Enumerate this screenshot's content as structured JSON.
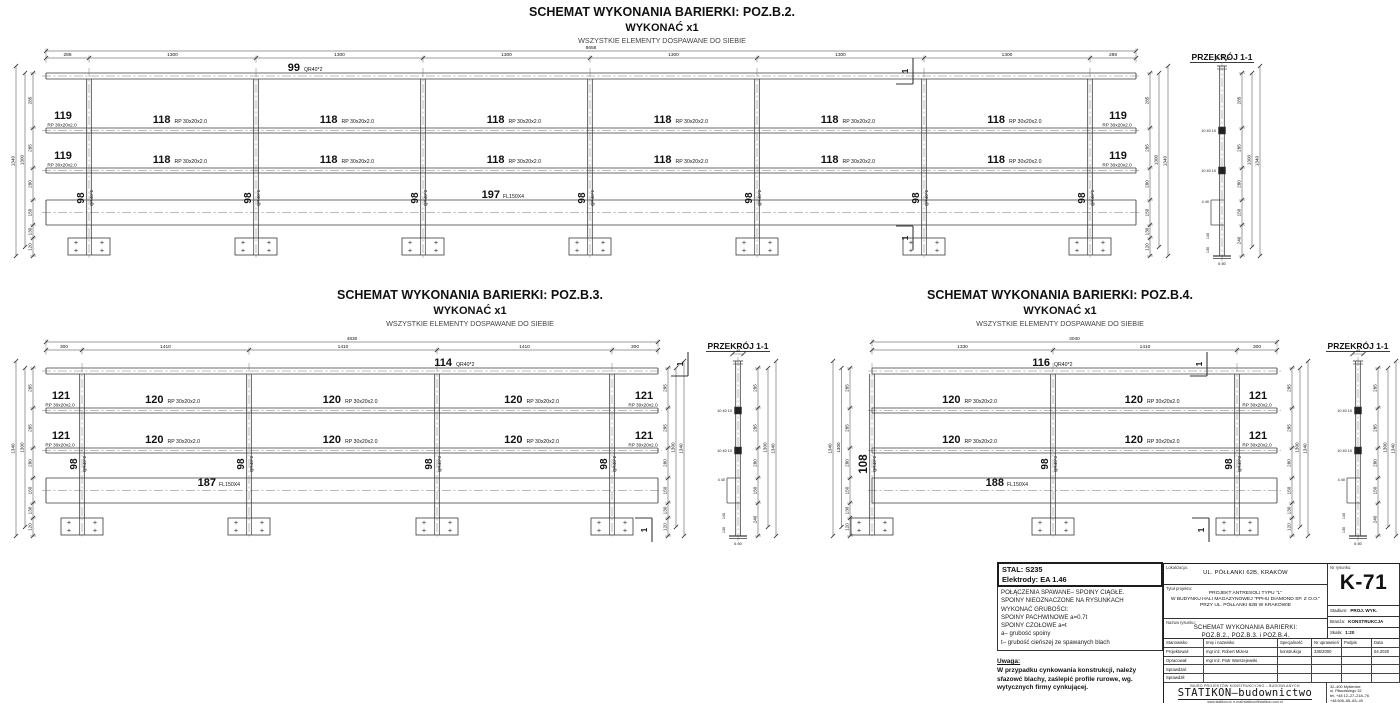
{
  "sheet": {
    "background": "#ffffff",
    "line_color": "#3a3a3a",
    "text_color": "#111111"
  },
  "drawings": {
    "b2": {
      "title": "SCHEMAT WYKONANIA BARIERKI: POZ.B.2.",
      "make_label": "WYKONAĆ x1",
      "weld_note": "WSZYSTKIE ELEMENTY DOSPAWANE DO SIEBIE",
      "total_dim": "8658",
      "top_dims": [
        "288",
        "1300",
        "1300",
        "1300",
        "1300",
        "1300",
        "1300",
        "288"
      ],
      "side_dims": [
        "285",
        "285",
        "280",
        "150",
        "130",
        "120"
      ],
      "overall_side_dims": [
        "1300",
        "1340"
      ],
      "top_rail": {
        "no": "99",
        "profile": "QR40*2"
      },
      "mid_rail": {
        "no": "118",
        "profile": "RP 30x20x2.0"
      },
      "end_rail": {
        "no": "119",
        "profile": "RP 30x20x2.0"
      },
      "post": {
        "profile": "QR40*2",
        "nos": [
          "98",
          "98",
          "98",
          "98",
          "98",
          "98",
          "98"
        ]
      },
      "kick_plate": {
        "no": "197",
        "profile": "FL150X4"
      },
      "section_mark": "1"
    },
    "b3": {
      "title": "SCHEMAT WYKONANIA BARIERKI: POZ.B.3.",
      "make_label": "WYKONAĆ x1",
      "weld_note": "WSZYSTKIE ELEMENTY DOSPAWANE DO SIEBIE",
      "total_dim": "4830",
      "top_dims": [
        "300",
        "1410",
        "1410",
        "1410",
        "300"
      ],
      "side_dims": [
        "285",
        "285",
        "280",
        "150",
        "130",
        "120"
      ],
      "overall_side_dims": [
        "1300",
        "1340"
      ],
      "top_rail": {
        "no": "114",
        "profile": "QR40*2"
      },
      "mid_rail": {
        "no": "120",
        "profile": "RP 30x20x2.0"
      },
      "end_rail": {
        "no": "121",
        "profile": "RP 30x20x2.0"
      },
      "post": {
        "profile": "QR40*2",
        "nos": [
          "98",
          "98",
          "98",
          "98"
        ]
      },
      "kick_plate": {
        "no": "187",
        "profile": "FL150X4"
      },
      "section_mark": "1"
    },
    "b4": {
      "title": "SCHEMAT WYKONANIA BARIERKI: POZ.B.4.",
      "make_label": "WYKONAĆ x1",
      "weld_note": "WSZYSTKIE ELEMENTY DOSPAWANE DO SIEBIE",
      "total_dim": "3040",
      "top_dims": [
        "1330",
        "1410",
        "300"
      ],
      "side_dims": [
        "285",
        "285",
        "280",
        "150",
        "130",
        "120"
      ],
      "overall_side_dims": [
        "1300",
        "1340"
      ],
      "top_rail": {
        "no": "116",
        "profile": "QR40*2"
      },
      "mid_rail": {
        "no": "120",
        "profile": "RP 30x20x2.0"
      },
      "end_rail": {
        "no": "121",
        "profile": "RP 30x20x2.0"
      },
      "post": {
        "profile": "QR40*2",
        "nos": [
          "108",
          "98",
          "98"
        ]
      },
      "kick_plate": {
        "no": "188",
        "profile": "FL150X4"
      },
      "section_mark": "1"
    }
  },
  "section": {
    "title": "PRZEKRÓJ 1-1",
    "side_dims": [
      "285",
      "285",
      "280",
      "150",
      "240"
    ],
    "overall_side_dims": [
      "1300",
      "1340"
    ],
    "detail_dims": {
      "top": "45",
      "rail": "10 40 10",
      "kick": "4 40",
      "lower": [
        "140",
        "130"
      ],
      "base": "6 80"
    }
  },
  "notes": {
    "material": [
      "STAL: S235",
      "Elektrody: EA 1.46"
    ],
    "weld": [
      "POŁĄCZENIA SPAWANE– SPOINY CIĄGŁE.",
      "SPOINY NIEOZNACZONE NA RYSUNKACH",
      "WYKONAĆ GRUBOŚCI:",
      "SPOINY PACHWINOWE a=0.7t",
      "SPOINY CZOŁOWE a=t",
      "a– grubość spoiny",
      "t– grubość cieńszej ze spawanych blach"
    ],
    "uwaga_label": "Uwaga:",
    "uwaga": [
      "W przypadku cynkowania konstrukcji, należy",
      "sfazowć blachy, zaślepić profile rurowe, wg.",
      "wytycznych firmy cynkującej."
    ]
  },
  "titleblock": {
    "lokalizacja_label": "Lokalizacja:",
    "lokalizacja": "UL. PÓŁŁANKI 62B, KRAKÓW",
    "tytul_label": "Tytuł projektu:",
    "tytul": [
      "PROJEKT ANTRESOLI TYPU \"L\"",
      "W BUDYNKU HALI MAGAZYNOWEJ \"PPHU DIAMOND SP. Z O.O.\"",
      "PRZY UL. PÓŁŁANKI 62B W KRAKOWIE"
    ],
    "nazwa_label": "Nazwa rysunku:",
    "nazwa": [
      "SCHEMAT WYKONANIA BARIERKI:",
      "POZ.B.2., POZ.B.3. i POZ.B.4."
    ],
    "nr_label": "Nr rysunku:",
    "nr": "K-71",
    "stadium_label": "Stadium:",
    "stadium": "PROJ. WYK.",
    "branza_label": "Branża:",
    "branza": "KONSTRUKCJA",
    "skala_label": "Skala:",
    "skala": "1:20",
    "table": {
      "headers": [
        "Stanowisko",
        "Imię i nazwisko",
        "Specjalność",
        "Nr uprawnień",
        "Podpis",
        "Data"
      ],
      "rows": [
        {
          "role": "Projektował:",
          "name": "mgr inż. Robert Mizera",
          "spec": "konstrukcja",
          "upr": "336/2000",
          "podpis": "",
          "data": "04.2020"
        },
        {
          "role": "Opracował:",
          "name": "mgr inż. Piotr Warszejewski",
          "spec": "",
          "upr": "",
          "podpis": "",
          "data": ""
        },
        {
          "role": "Sprawdzał:",
          "name": "",
          "spec": "",
          "upr": "",
          "podpis": "",
          "data": ""
        },
        {
          "role": "Sprawdził:",
          "name": "",
          "spec": "",
          "upr": "",
          "podpis": "",
          "data": ""
        }
      ]
    },
    "biuro": "BIURO PROJEKTÓW KONSTRUKCYJNO – BUDOWLANYCH",
    "firma": "STATIKON–budownictwo",
    "www": "www.statikon.pl, e-mail:statikon@statikon.com.pl",
    "adres": [
      "32–400 Myślenice",
      "ul. Piłsudskiego 32",
      "tel. +48 12–27–218–76",
      "+48 606–65–83–49"
    ]
  }
}
